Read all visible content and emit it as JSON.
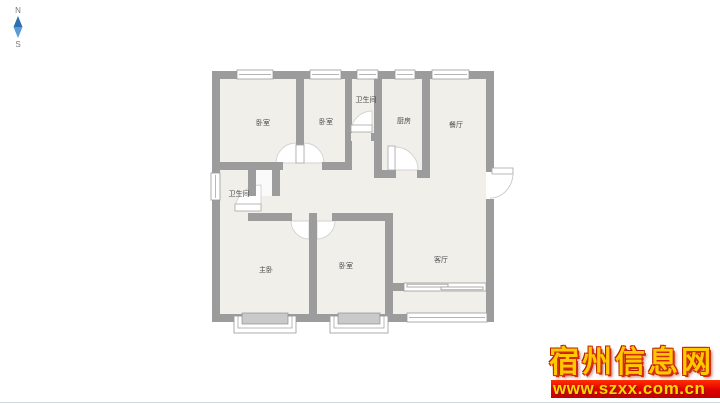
{
  "compass": {
    "north_label": "N",
    "south_label": "S",
    "needle_top_color": "#2e6fae",
    "needle_bottom_color": "#5b9bd5"
  },
  "floorplan": {
    "wall_color": "#9c9c9c",
    "room_fill": "#f0efe9",
    "door_arc_stroke": "#d2d2d2",
    "rooms": [
      {
        "name": "bedroom-top-left",
        "label": "卧室"
      },
      {
        "name": "bedroom-top-middle",
        "label": "卧室"
      },
      {
        "name": "bathroom-top",
        "label": "卫生间"
      },
      {
        "name": "kitchen",
        "label": "厨房"
      },
      {
        "name": "dining-room",
        "label": "餐厅"
      },
      {
        "name": "bathroom-left",
        "label": "卫生间"
      },
      {
        "name": "master-bedroom",
        "label": "主卧"
      },
      {
        "name": "bedroom-bottom",
        "label": "卧室"
      },
      {
        "name": "living-room",
        "label": "客厅"
      }
    ]
  },
  "watermark": {
    "site_name": "宿州信息网",
    "site_url": "www.szxx.com.cn",
    "title_color": "#ffc800",
    "banner_bg": "#e00000",
    "banner_text_color": "#ffd800"
  }
}
